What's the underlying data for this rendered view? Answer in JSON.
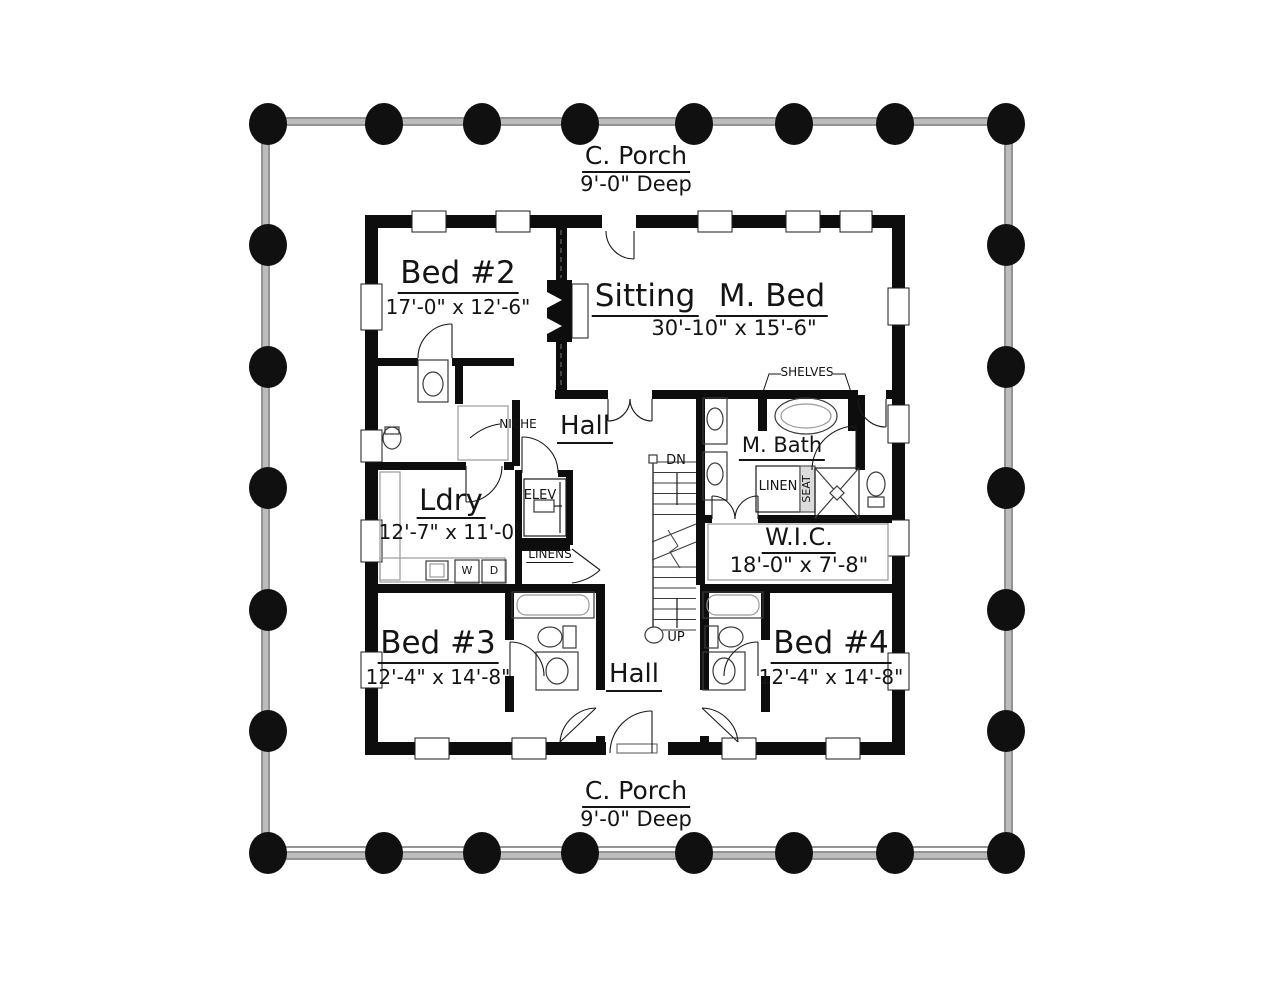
{
  "plan": {
    "porch_top": {
      "title": "C. Porch",
      "subtitle": "9'-0\" Deep"
    },
    "porch_bottom": {
      "title": "C. Porch",
      "subtitle": "9'-0\" Deep"
    },
    "rooms": {
      "bed2": {
        "title": "Bed #2",
        "dims": "17'-0\" x 12'-6\""
      },
      "sitting": {
        "title": "Sitting"
      },
      "mbed": {
        "title": "M. Bed"
      },
      "sitting_mbed_dims": "30'-10\" x 15'-6\"",
      "hall_upper": {
        "title": "Hall"
      },
      "hall_lower": {
        "title": "Hall"
      },
      "ldry": {
        "title": "Ldry",
        "dims": "12'-7\" x 11'-0\""
      },
      "mbath": {
        "title": "M. Bath"
      },
      "wic": {
        "title": "W.I.C.",
        "dims": "18'-0\" x 7'-8\""
      },
      "bed3": {
        "title": "Bed #3",
        "dims": "12'-4\" x 14'-8\""
      },
      "bed4": {
        "title": "Bed #4",
        "dims": "12'-4\" x 14'-8\""
      }
    },
    "annotations": {
      "niche": "NICHE",
      "shelves": "SHELVES",
      "linen": "LINEN",
      "seat": "SEAT",
      "elev": "ELEV",
      "linens": "LINENS",
      "washer": "W",
      "dryer": "D",
      "down": "DN",
      "up": "UP"
    },
    "colors": {
      "wall": "#0d0d0d",
      "column": "#101010",
      "porch_rail_gray": "#bcbcbc",
      "fixture_line": "#3a3a3a",
      "light_line": "#9a9a9a",
      "text": "#141414"
    }
  }
}
